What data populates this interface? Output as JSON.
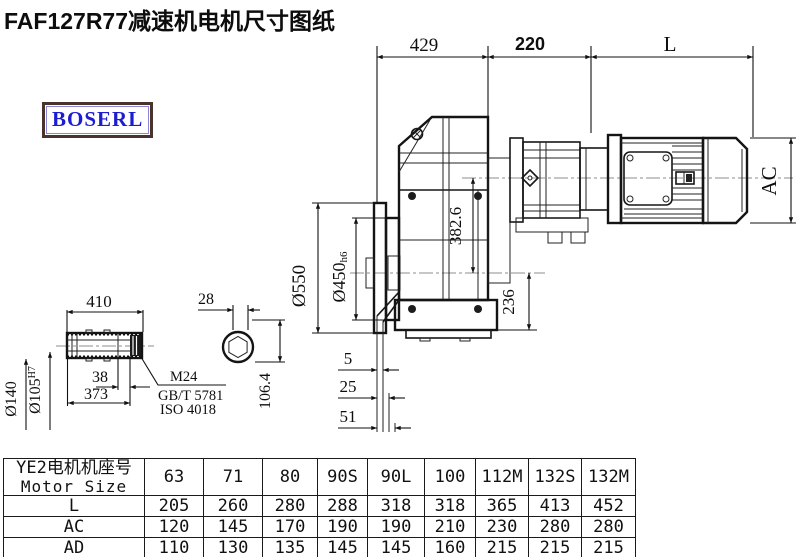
{
  "title": "FAF127R77减速机电机尺寸图纸",
  "logo": {
    "text": "BOSERL"
  },
  "colors": {
    "logo_text": "#1c1cd2",
    "logo_border": "#4a332c",
    "line": "#141414",
    "centerline": "#8d8d8d"
  },
  "dimensions": {
    "top_429": "429",
    "top_220": "220",
    "top_L": "L",
    "flange_od": "Ø550",
    "spigot_dia": "Ø450",
    "spigot_fit": "h6",
    "axis_distance": "382.6",
    "axis_to_base": "236",
    "motor_ac": "AC",
    "face_5": "5",
    "face_25": "25",
    "face_51": "51",
    "shaft_410": "410",
    "shaft_373": "373",
    "shaft_38": "38",
    "shaft_od": "Ø140",
    "bore_dia": "Ø105",
    "bore_fit": "H7",
    "end_28": "28",
    "end_106": "106.4",
    "thread": "M24",
    "standard_gb": "GB/T 5781",
    "standard_iso": "ISO 4018"
  },
  "table": {
    "header_cn": "YE2电机机座号",
    "header_en": "Motor Size",
    "columns": [
      "63",
      "71",
      "80",
      "90S",
      "90L",
      "100",
      "112M",
      "132S",
      "132M"
    ],
    "rows": [
      {
        "label": "L",
        "values": [
          "205",
          "260",
          "280",
          "288",
          "318",
          "318",
          "365",
          "413",
          "452"
        ]
      },
      {
        "label": "AC",
        "values": [
          "120",
          "145",
          "170",
          "190",
          "190",
          "210",
          "230",
          "280",
          "280"
        ]
      },
      {
        "label": "AD",
        "values": [
          "110",
          "130",
          "135",
          "145",
          "145",
          "160",
          "215",
          "215",
          "215"
        ]
      }
    ]
  }
}
